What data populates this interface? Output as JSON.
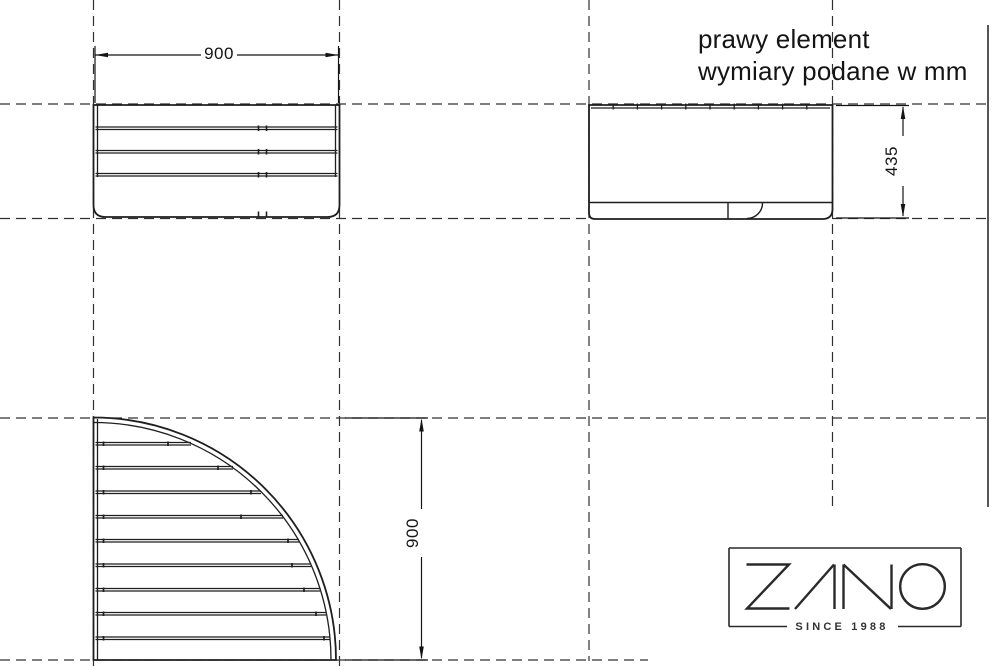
{
  "drawing": {
    "title_line1": "prawy element",
    "title_line2": "wymiary podane w mm",
    "dim_front_width_mm": "900",
    "dim_side_height_mm": "435",
    "dim_plan_radius_mm": "900"
  },
  "logo": {
    "brand": "ZANO",
    "tagline": "SINCE 1988"
  },
  "colors": {
    "background": "#ffffff",
    "line": "#1e1e1e",
    "dashed_line": "#303030",
    "logo": "#2a2a2a"
  }
}
